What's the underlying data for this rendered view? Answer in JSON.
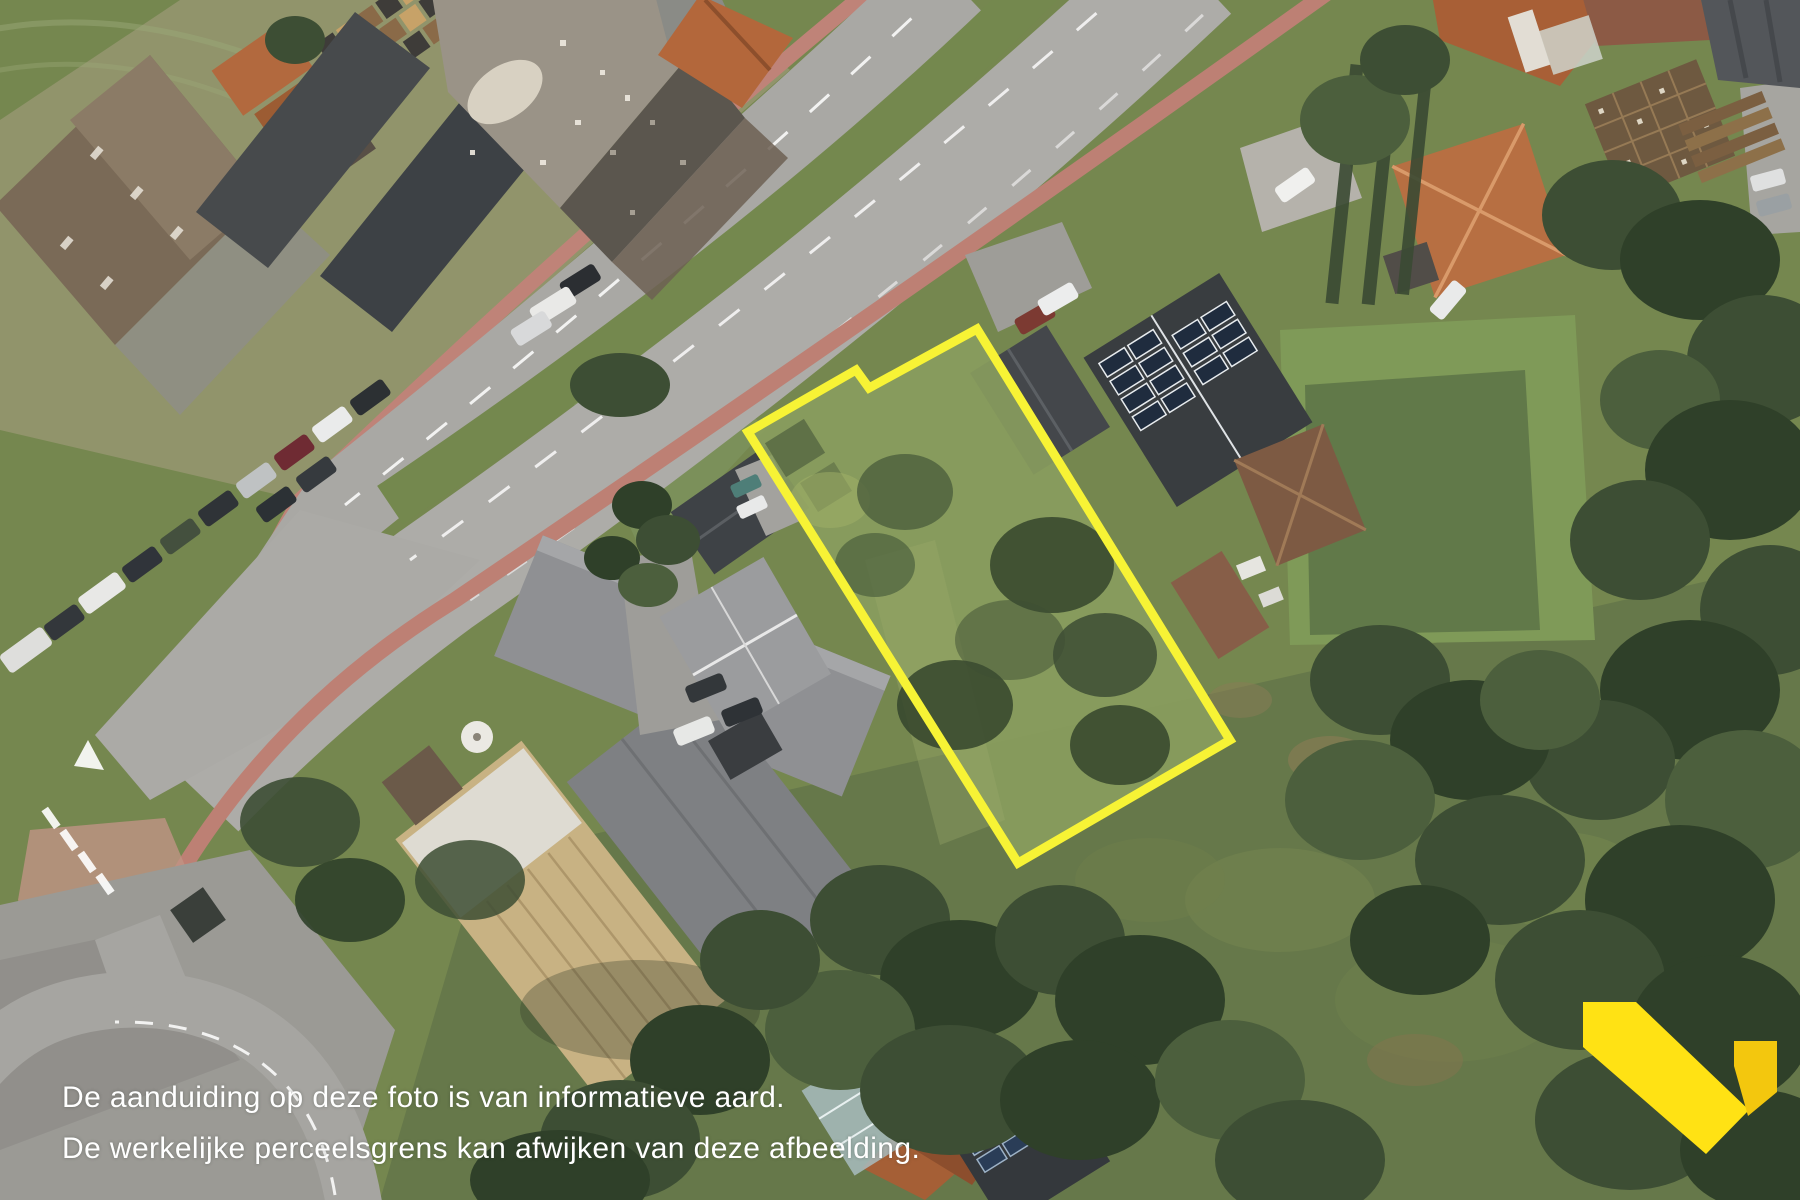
{
  "disclaimer": {
    "line1": "De aanduiding op deze foto is van informatieve aard.",
    "line2": "De werkelijke perceelsgrens kan afwijken van deze afbeelding.",
    "text_color": "#ffffff"
  },
  "parcel": {
    "outline_points": "977,329 1230,740 1018,863 748,432 856,370 869,388",
    "stroke_color": "#f7f335",
    "stroke_width": "9"
  },
  "logo": {
    "main_points": "1583,1002 1636,1002 1749,1110 1706,1154 1583,1047",
    "accent_points": "1734,1041 1777,1041 1777,1092 1748,1116 1734,1066",
    "primary_color": "#ffe214",
    "secondary_color": "#f3c70e"
  }
}
